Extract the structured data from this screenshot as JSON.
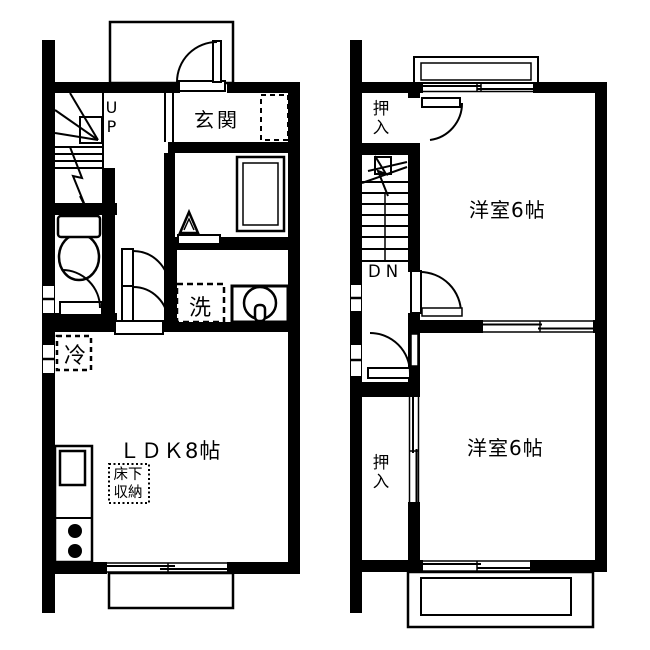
{
  "colors": {
    "ink": "#000000",
    "background": "#ffffff"
  },
  "floor1": {
    "entrance_label": "玄関",
    "stairs_label": "UP",
    "washer_label": "洗",
    "fridge_label": "冷",
    "living_label": "ＬＤＫ8帖",
    "floor_storage_label": "床下収納"
  },
  "floor2": {
    "closet_top_label": "押入",
    "stairs_label": "DN",
    "bedroom_top_label": "洋室6帖",
    "bedroom_bottom_label": "洋室6帖",
    "closet_bottom_label": "押入"
  }
}
